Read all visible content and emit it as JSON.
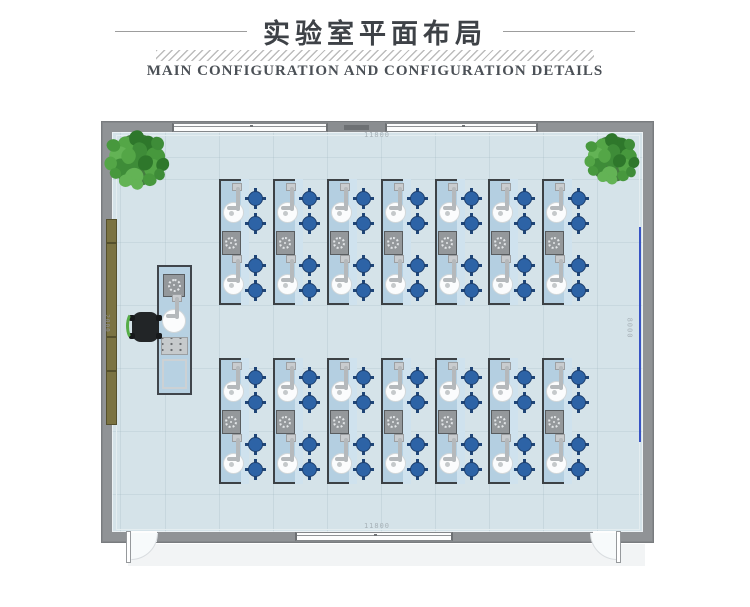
{
  "header": {
    "title": "实验室平面布局",
    "subtitle": "MAIN CONFIGURATION AND CONFIGURATION DETAILS"
  },
  "plan": {
    "room": {
      "width_label_top": "11800",
      "width_label_bottom": "11800",
      "height_label_right": "8000",
      "cabinet_label_left": "2000"
    },
    "benches": {
      "rows": 2,
      "columns": 7,
      "stools_per_bench": 4,
      "features": [
        "faucet-sink-top",
        "gas-valve-center",
        "faucet-sink-bottom"
      ]
    },
    "teacher_station": {
      "features": [
        "gas-valve",
        "faucet",
        "sink",
        "control-panel",
        "work-surface"
      ],
      "chairs": 1
    },
    "plants": 2,
    "doors": 2,
    "windows": {
      "top": 2,
      "bottom": 1
    },
    "colors": {
      "floor": "#d5e3e9",
      "wall": "#909396",
      "bench": "#b4cfe1",
      "bench_service_strip": "#cfe2ee",
      "stool": "#2d63a6",
      "plant": "#459040",
      "side_cabinet": "#7b7342",
      "dimension_line": "#3753c4",
      "chair": "#222527",
      "chair_accent": "#55ad47"
    }
  }
}
